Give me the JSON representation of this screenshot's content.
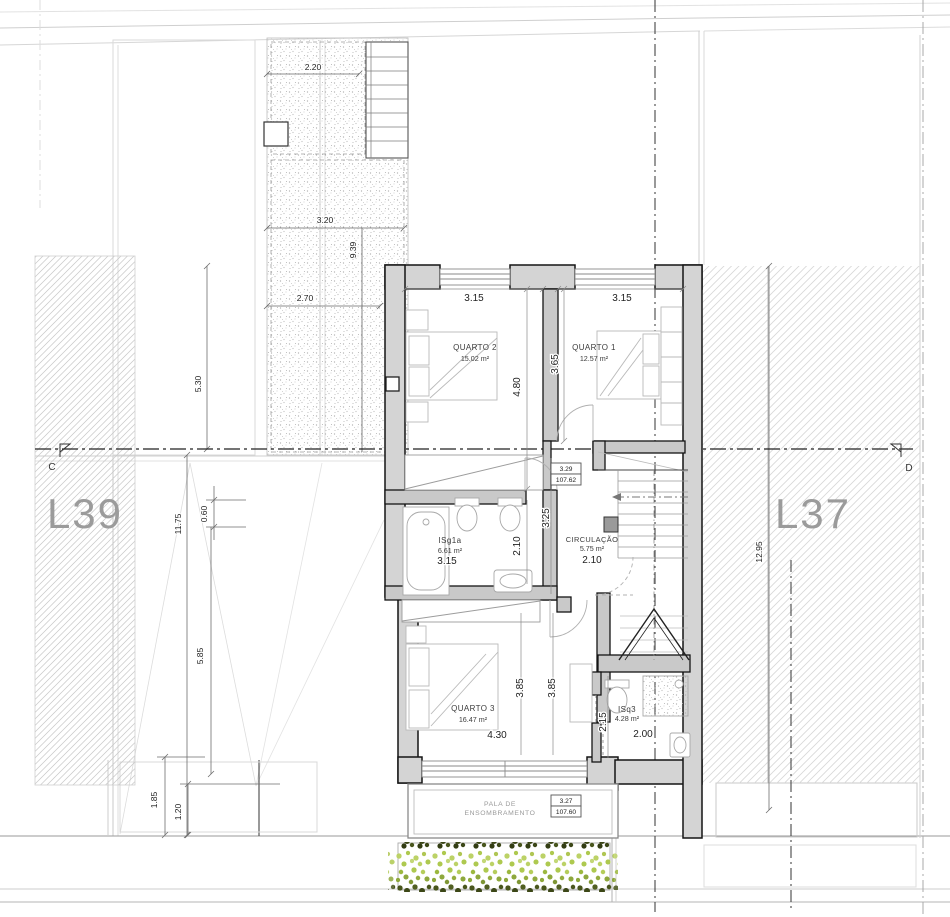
{
  "site": {
    "left_lot": "L39",
    "right_lot": "L37",
    "section_c": "C",
    "section_d": "D"
  },
  "rooms": {
    "q2": {
      "name": "QUARTO 2",
      "area": "15.02 m²"
    },
    "q1": {
      "name": "QUARTO 1",
      "area": "12.57 m²"
    },
    "bath1": {
      "name": "ISg1a",
      "area": "6.61 m²"
    },
    "circ": {
      "name": "CIRCULAÇÃO",
      "area": "5.75 m²"
    },
    "q3": {
      "name": "QUARTO 3",
      "area": "16.47 m²"
    },
    "bath3": {
      "name": "ISq3",
      "area": "4.28 m²"
    }
  },
  "dims": {
    "q2_w": "3.15",
    "q1_w": "3.15",
    "q2_h": "4.80",
    "q1_h": "3.65",
    "hall_h": "3.25",
    "bath1_w": "3.15",
    "bath1_h": "2.10",
    "circ_w": "2.10",
    "q3_w": "4.30",
    "q3_h1": "3.85",
    "q3_h2": "3.85",
    "bath3_w": "2.00",
    "bath3_h": "2.15"
  },
  "terrace": {
    "w1": "2.20",
    "w2": "3.20",
    "w3": "2.70",
    "h": "9.39"
  },
  "chain": {
    "a": "5.30",
    "b": "11.75",
    "c": "0.60",
    "d": "5.85",
    "e": "1.85",
    "f": "1.20",
    "g": "12.95"
  },
  "levels": {
    "upper": {
      "rel": "3.29",
      "abs": "107.62"
    },
    "pala": {
      "rel": "3.27",
      "abs": "107.60"
    }
  },
  "shade": {
    "line1": "PALA DE",
    "line2": "ENSOMBRAMENTO"
  }
}
